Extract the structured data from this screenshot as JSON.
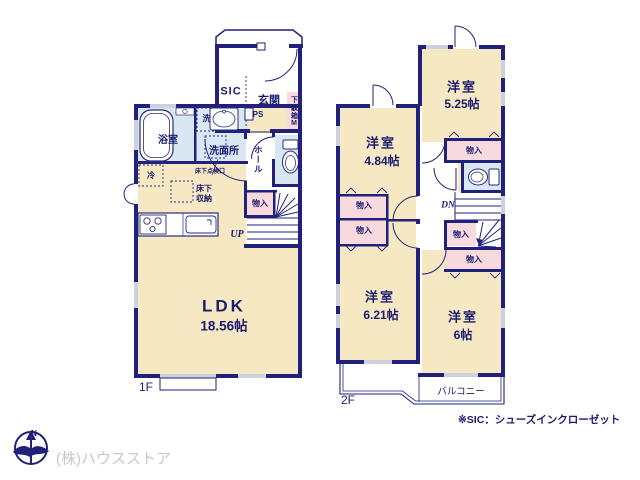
{
  "floor1": {
    "floor_label": "1F",
    "ldk_name": "LDK",
    "ldk_size": "18.56帖",
    "bathroom": "浴室",
    "laundry": "洗",
    "washroom": "洗面所",
    "sic": "SIC",
    "entrance": "玄関",
    "shoe_box": "下駄箱M",
    "ps": "PS",
    "hall": "ホール",
    "closet": "物入",
    "up": "UP",
    "fridge": "冷",
    "underfloor_access": "床下点検口",
    "underfloor_storage_line1": "床下",
    "underfloor_storage_line2": "収納"
  },
  "floor2": {
    "floor_label": "2F",
    "room_5_25_name": "洋室",
    "room_5_25_size": "5.25帖",
    "room_4_84_name": "洋室",
    "room_4_84_size": "4.84帖",
    "room_6_21_name": "洋室",
    "room_6_21_size": "6.21帖",
    "room_6_name": "洋室",
    "room_6_size": "6帖",
    "closet": "物入",
    "dn": "DN",
    "balcony": "バルコニー"
  },
  "footer": {
    "note": "※SIC：シューズインクローゼット",
    "company": "(株)ハウスストア",
    "compass_north": "N"
  },
  "colors": {
    "wall": "#21217b",
    "room_cream": "#f6e8c3",
    "water_blue": "#d9e7f3",
    "closet_pink": "#f7d9de",
    "window_gray": "#ccd2dd",
    "text_navy": "#1b1b70",
    "company_gray": "#c8c8c8"
  }
}
